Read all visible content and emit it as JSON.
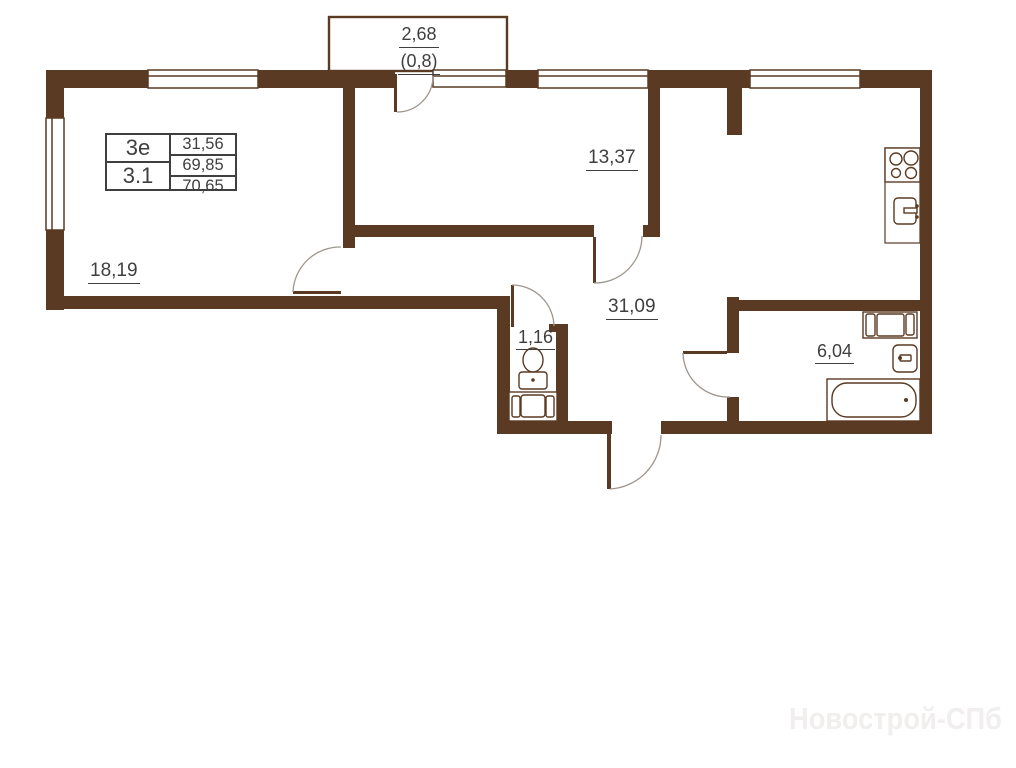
{
  "legend": {
    "unit_type": "3е",
    "layout_code": "3.1",
    "living_area": "31,56",
    "floor_area": "69,85",
    "total_area": "70,65"
  },
  "balcony": {
    "area": "2,68",
    "area_reduced": "(0,8)"
  },
  "rooms": {
    "living_room": {
      "area": "18,19"
    },
    "bedroom": {
      "area": "13,37"
    },
    "kitchen_living": {
      "area": "31,09"
    },
    "wc": {
      "area": "1,16"
    },
    "bathroom": {
      "area": "6,04"
    }
  },
  "watermark": "Новострой-СПб",
  "colors": {
    "wall": "#5a3a22",
    "label_text": "#3f3f3f",
    "door_arc": "#9e968c",
    "watermark": "#f1efee"
  },
  "icons": [
    "toilet-icon",
    "vanity-sink-icon",
    "washing-machine-icon",
    "bathroom-sink-icon",
    "bathtub-icon",
    "stove-icon",
    "kitchen-sink-icon",
    "balcony-outline",
    "window-icon",
    "door-arc-icon"
  ]
}
